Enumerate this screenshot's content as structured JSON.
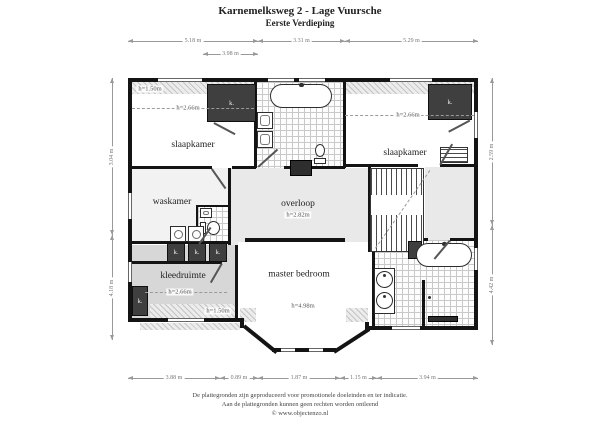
{
  "title": {
    "line1": "Karnemelksweg 2 - Lage Vuursche",
    "line2": "Eerste Verdieping"
  },
  "labels": {
    "closet": "k."
  },
  "rooms": {
    "slaapkamer_left": {
      "name": "slaapkamer",
      "ceiling": "h=2.66m",
      "knee_wall": "h=1.50m"
    },
    "slaapkamer_right": {
      "name": "slaapkamer",
      "ceiling": "h=2.66m"
    },
    "waskamer": {
      "name": "waskamer"
    },
    "overloop": {
      "name": "overloop",
      "ceiling": "h=2.82m"
    },
    "kleedruimte": {
      "name": "kleedruimte",
      "ceiling": "h=2.66m",
      "knee_wall": "h=1.50m"
    },
    "master_bedroom": {
      "name": "master bedroom",
      "ceiling": "h=4.98m"
    }
  },
  "dimensions": {
    "top": [
      "5.18 m",
      "3.31 m",
      "5.29 m"
    ],
    "top_inner": "3.98 m",
    "bottom": [
      "3.88 m",
      "0.89 m",
      "1.87 m",
      "1.15 m",
      "3.94 m"
    ],
    "left": [
      "3.04 m",
      "4.18 m"
    ],
    "right": [
      "2.59 m",
      "4.42 m"
    ]
  },
  "footer": {
    "line1": "De plattegronden zijn geproduceerd voor promotionele doeleinden en ter indicatie.",
    "line2": "Aan de plattegronden kunnen geen rechten worden ontleend",
    "line3": "© www.objectenzo.nl"
  }
}
